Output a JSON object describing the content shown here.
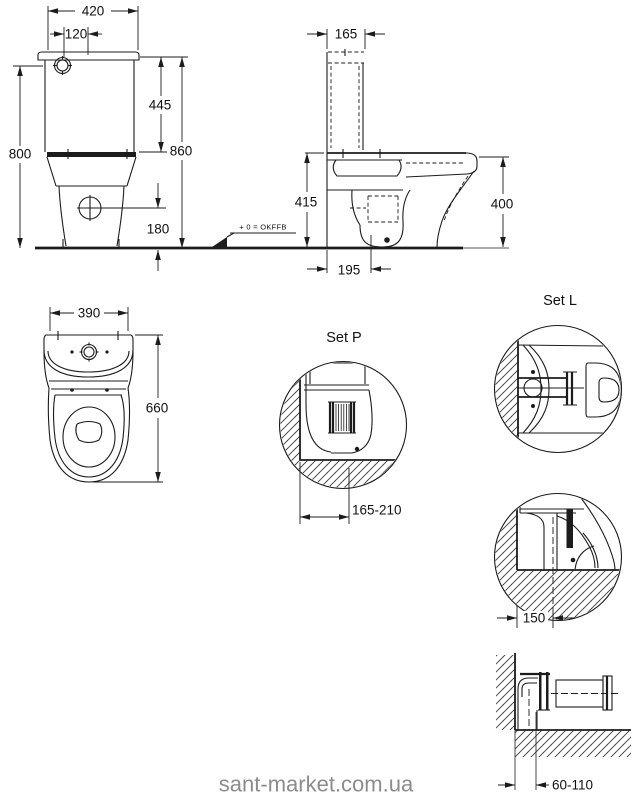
{
  "drawing": {
    "front_view": {
      "width": "420",
      "button_offset": "120",
      "tank_height": "445",
      "height_body": "800",
      "height_total": "860",
      "drain_height": "180"
    },
    "side_view": {
      "tank_depth": "165",
      "height_with_seat": "415",
      "height_rim": "400",
      "outlet_distance": "195",
      "datum": "+ 0 = OKFFB"
    },
    "top_view": {
      "width": "390",
      "depth": "660"
    },
    "set_p": {
      "label": "Set P",
      "outlet_range": "165-210"
    },
    "set_l": {
      "label": "Set L",
      "floor_outlet_distance": "150",
      "wall_outlet_range": "60-110"
    },
    "watermark": "sant-market.com.ua"
  },
  "colors": {
    "line": "#1c1c1c",
    "watermark": "#8c8c8c",
    "background": "#ffffff"
  }
}
